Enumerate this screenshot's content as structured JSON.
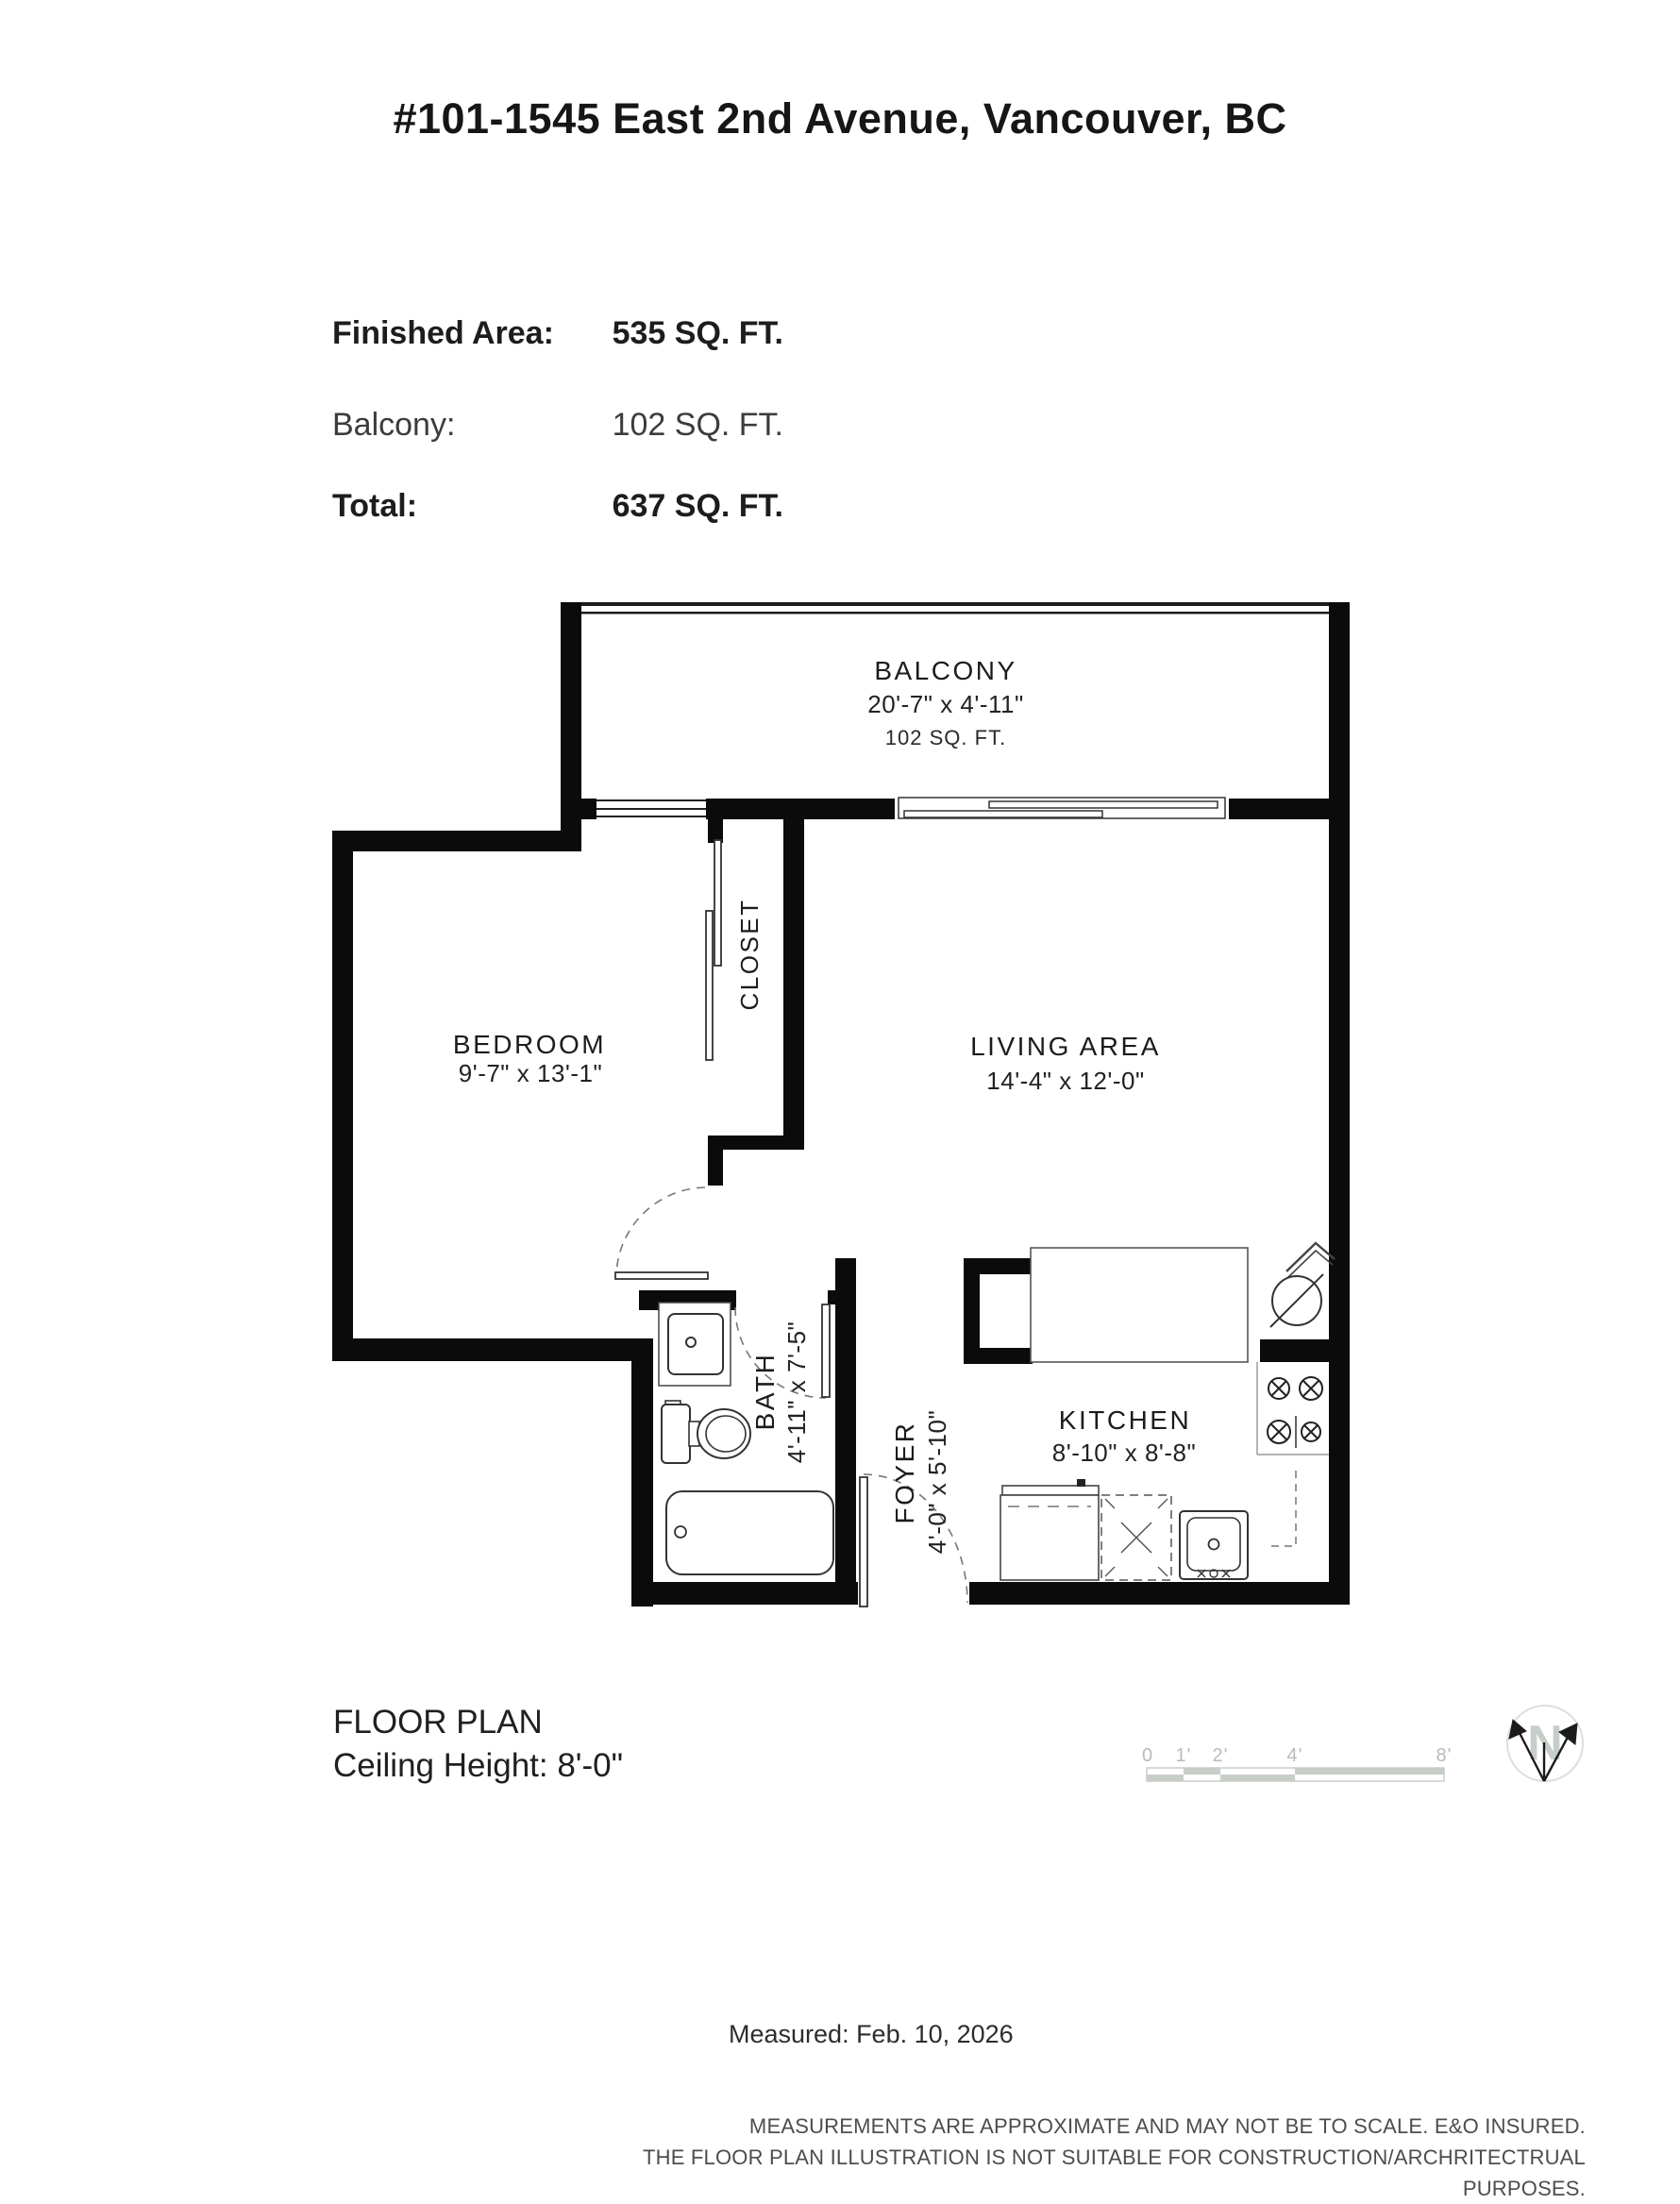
{
  "title": "#101-1545 East 2nd Avenue, Vancouver, BC",
  "area_summary": {
    "rows": [
      {
        "label": "Finished Area:",
        "value": "535 SQ. FT."
      },
      {
        "label": "Balcony:",
        "value": "102 SQ. FT."
      },
      {
        "label": "Total:",
        "value": "637 SQ. FT."
      }
    ]
  },
  "floor_plan": {
    "rooms": {
      "balcony": {
        "name": "BALCONY",
        "dimensions": "20'-7\" x 4'-11\"",
        "area": "102 SQ. FT."
      },
      "bedroom": {
        "name": "BEDROOM",
        "dimensions": "9'-7\" x 13'-1\""
      },
      "closet": {
        "name": "CLOSET"
      },
      "living": {
        "name": "LIVING AREA",
        "dimensions": "14'-4\" x 12'-0\""
      },
      "bath": {
        "name": "BATH",
        "dimensions": "4'-11\" x 7'-5\""
      },
      "foyer": {
        "name": "FOYER",
        "dimensions": "4'-0\" x 5'-10\""
      },
      "kitchen": {
        "name": "KITCHEN",
        "dimensions": "8'-10\" x 8'-8\""
      }
    }
  },
  "scale_bar": {
    "ticks": [
      "0",
      "1'",
      "2'",
      "4'",
      "8'"
    ]
  },
  "compass": {
    "label": "N"
  },
  "footer": {
    "plan_label": "FLOOR PLAN",
    "ceiling_height": "Ceiling Height: 8'-0\"",
    "measured": "Measured: Feb. 10, 2026",
    "disclaimer_line1": "MEASUREMENTS ARE APPROXIMATE AND MAY NOT BE TO SCALE. E&O INSURED.",
    "disclaimer_line2": "THE FLOOR PLAN ILLUSTRATION IS NOT SUITABLE FOR CONSTRUCTION/ARCHRITECTRUAL PURPOSES."
  }
}
